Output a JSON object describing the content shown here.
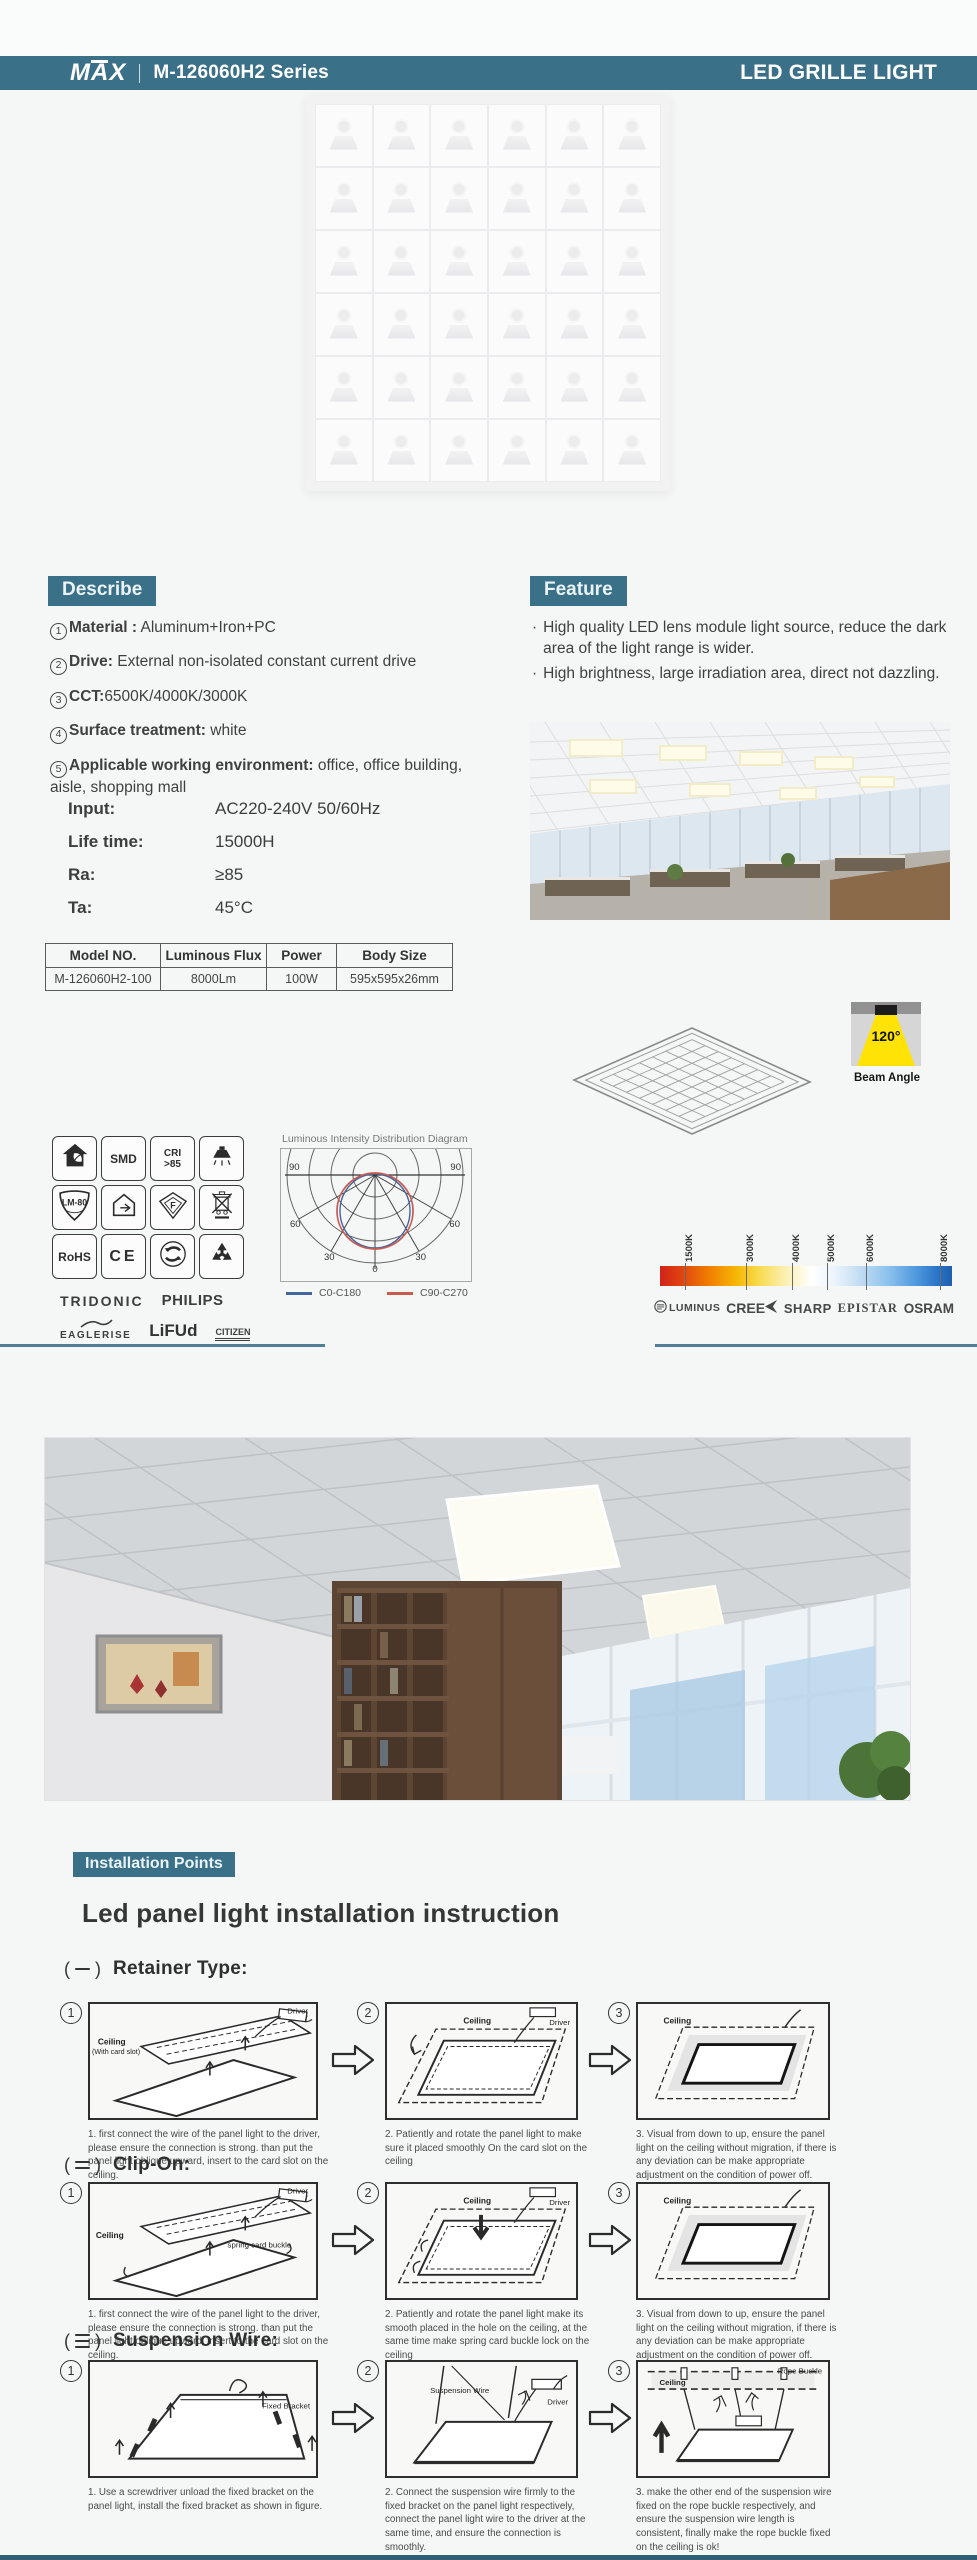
{
  "header": {
    "brand": "MAX",
    "series": "M-126060H2 Series",
    "product": "LED GRILLE LIGHT"
  },
  "describe": {
    "title": "Describe",
    "items": [
      {
        "num": "1",
        "label": "Material :",
        "text": " Aluminum+Iron+PC"
      },
      {
        "num": "2",
        "label": "Drive:",
        "text": " External non-isolated constant current drive"
      },
      {
        "num": "3",
        "label": "CCT:",
        "text": "6500K/4000K/3000K"
      },
      {
        "num": "4",
        "label": "Surface treatment:",
        "text": " white"
      },
      {
        "num": "5",
        "label": "Applicable working environment:",
        "text": " office, office building, aisle, shopping mall"
      }
    ]
  },
  "feature": {
    "title": "Feature",
    "bullets": [
      "High quality LED lens module light source, reduce the dark area of the light range is wider.",
      "High brightness, large irradiation area, direct not dazzling."
    ]
  },
  "specs": [
    {
      "label": "Input:",
      "value": "AC220-240V  50/60Hz"
    },
    {
      "label": "Life time:",
      "value": "15000H"
    },
    {
      "label": "Ra:",
      "value": "≥85"
    },
    {
      "label": "Ta:",
      "value": "45°C"
    }
  ],
  "table": {
    "headers": [
      "Model NO.",
      "Luminous Flux",
      "Power",
      "Body Size"
    ],
    "rows": [
      [
        "M-126060H2-100",
        "8000Lm",
        "100W",
        "595x595x26mm"
      ]
    ]
  },
  "beam": {
    "angle": "120°",
    "label": "Beam Angle"
  },
  "cert_icons": [
    {
      "name": "eco-house-icon",
      "kind": "eco-house",
      "text": ""
    },
    {
      "name": "smd-badge",
      "kind": "text",
      "text": "SMD"
    },
    {
      "name": "cri-badge",
      "kind": "text2",
      "text": "CRI|>85"
    },
    {
      "name": "downlight-icon",
      "kind": "downlight",
      "text": ""
    },
    {
      "name": "lm80-badge",
      "kind": "shield",
      "text": "LM-80"
    },
    {
      "name": "house-energy-icon",
      "kind": "house-plug",
      "text": ""
    },
    {
      "name": "f-mark-icon",
      "kind": "f-mark",
      "text": "F"
    },
    {
      "name": "weee-bin-icon",
      "kind": "weee",
      "text": ""
    },
    {
      "name": "rohs-badge",
      "kind": "text",
      "text": "RoHS"
    },
    {
      "name": "ce-mark",
      "kind": "text-ce",
      "text": "CE"
    },
    {
      "name": "green-dot-icon",
      "kind": "green-dot",
      "text": ""
    },
    {
      "name": "recycle-icon",
      "kind": "recycle",
      "text": ""
    }
  ],
  "driver_brands": [
    "TRIDONIC",
    "PHILIPS",
    "EAGLERISE",
    "LiFUd",
    "CITIZEN"
  ],
  "chip_brands": [
    "LUMINUS",
    "CREE",
    "SHARP",
    "EPISTAR",
    "OSRAM"
  ],
  "polar_diagram": {
    "title": "Luminous Intensity Distribution Diagram",
    "angle_ticks": [
      "90",
      "60",
      "30",
      "0"
    ],
    "legend": [
      {
        "label": "C0-C180",
        "color": "#44659e"
      },
      {
        "label": "C90-C270",
        "color": "#c95a50"
      }
    ]
  },
  "cct_scale": {
    "ticks": [
      {
        "label": "1500K",
        "pos": 0.087
      },
      {
        "label": "3000K",
        "pos": 0.296
      },
      {
        "label": "4000K",
        "pos": 0.453
      },
      {
        "label": "5000K",
        "pos": 0.571
      },
      {
        "label": "6000K",
        "pos": 0.704
      },
      {
        "label": "8000K",
        "pos": 0.958
      }
    ]
  },
  "installation": {
    "label": "Installation Points",
    "heading": "Led panel light installation instruction",
    "sections": [
      {
        "numeral": "一",
        "title": "Retainer Type:",
        "steps": [
          {
            "num": "1",
            "variant": "insert",
            "labels": {
              "ceiling": "Ceiling",
              "ceiling_sub": "(With card slot)",
              "driver": "Driver"
            },
            "caption": "1. first connect the wire of the panel light to the driver, please ensure the connection is strong. than put the panel light oblique upward, insert to the card slot on the ceiling."
          },
          {
            "num": "2",
            "variant": "rotate",
            "labels": {
              "ceiling": "Ceiling",
              "driver": "Driver"
            },
            "caption": "2. Patiently and rotate the panel light to make sure it placed smoothly On the card slot on the ceiling"
          },
          {
            "num": "3",
            "variant": "done",
            "labels": {
              "ceiling": "Ceiling"
            },
            "caption": "3. Visual from down to up, ensure the panel light on the ceiling without migration, if there is any deviation can be make appropriate adjustment on the condition of power off."
          }
        ]
      },
      {
        "numeral": "二",
        "title": "Clip-On:",
        "steps": [
          {
            "num": "1",
            "variant": "insert-spring",
            "labels": {
              "ceiling": "Ceiling",
              "driver": "Driver",
              "spring": "spring card buckle"
            },
            "caption": "1. first connect the wire of the panel light to the driver, please ensure the connection is strong. than put the panel light oblique upward, insert to the card slot on the ceiling."
          },
          {
            "num": "2",
            "variant": "rotate-spring",
            "labels": {
              "ceiling": "Ceiling",
              "driver": "Driver"
            },
            "caption": "2. Patiently and rotate the panel light make its smooth placed in the hole on the ceiling, at the same time make spring card buckle lock on the ceiling"
          },
          {
            "num": "3",
            "variant": "done",
            "labels": {
              "ceiling": "Ceiling"
            },
            "caption": "3. Visual from down to up, ensure the panel light on the ceiling without migration, if there is any deviation can be make appropriate adjustment on the condition of power off."
          }
        ]
      },
      {
        "numeral": "三",
        "title": "Suspension Wire:",
        "steps": [
          {
            "num": "1",
            "variant": "bracket",
            "labels": {
              "bracket": "Fixed Bracket"
            },
            "caption": "1. Use a screwdriver unload the fixed bracket on the panel light, install the fixed bracket as shown in figure."
          },
          {
            "num": "2",
            "variant": "suspend",
            "labels": {
              "wire": "Suspension Wire",
              "driver": "Driver"
            },
            "caption": "2. Connect the suspension wire firmly to the fixed bracket on the panel light respectively, connect the panel light wire to the driver at the same time, and ensure the connection is smoothly."
          },
          {
            "num": "3",
            "variant": "rope",
            "labels": {
              "ceiling": "Ceiling",
              "rope": "Rope Buckle"
            },
            "caption": "3. make the other end of the suspension wire fixed on the rope buckle respectively, and ensure the suspension wire length is consistent, finally make the rope buckle fixed on the ceiling is ok!"
          }
        ]
      }
    ]
  },
  "colors": {
    "accent": "#3b7089",
    "divider": "#4d8096"
  }
}
